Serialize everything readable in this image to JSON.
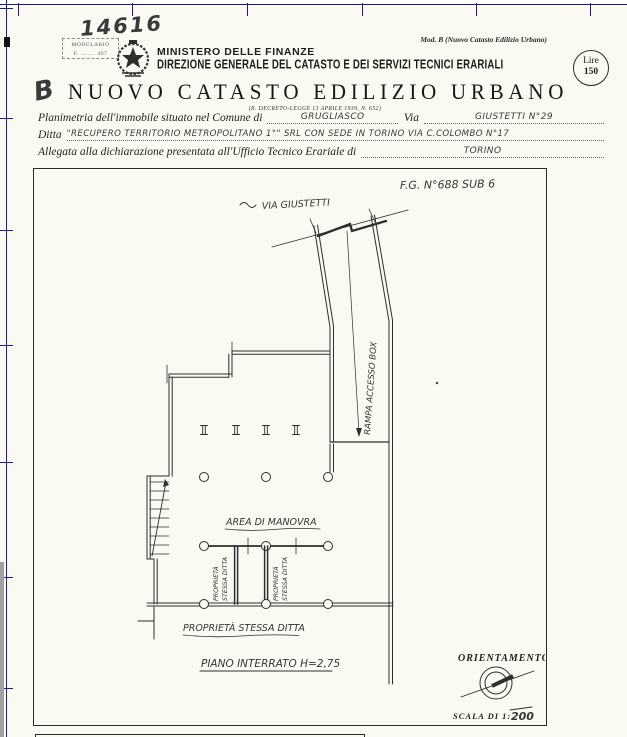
{
  "header": {
    "handwritten_number": "14616",
    "modulario_line1": "MODULARIO",
    "modulario_line2": "F. ........ 497",
    "mod_b_note": "Mod. B (Nuovo Catasto Edilizio Urbano)",
    "ministry": "MINISTERO DELLE FINANZE",
    "direction": "DIREZIONE GENERALE DEL CATASTO E DEI SERVIZI TECNICI ERARIALI",
    "stamp_mark": "B",
    "title": "NUOVO CATASTO EDILIZIO URBANO",
    "subtitle": "(R. DECRETO-LEGGE 13 APRILE 1939, N. 652)",
    "fee_line1": "Lire",
    "fee_line2": "150"
  },
  "form": {
    "line1_label": "Planimetria dell'immobile situato nel Comune di",
    "line1_value": "GRUGLIASCO",
    "line1_label2": "Via",
    "line1_value2": "GIUSTETTI  N°29",
    "line2_label": "Ditta",
    "line2_value": "\"RECUPERO TERRITORIO METROPOLITANO 1°\" SRL CON SEDE IN TORINO VIA C.COLOMBO N°17",
    "line3_label": "Allegata alla dichiarazione presentata all'Ufficio Tecnico Erariale di",
    "line3_value": "TORINO"
  },
  "plan": {
    "sheet_ref": "F.G.  N°688  SUB 6",
    "street_label": "VIA GIUSTETTI",
    "ramp_label": "RAMPA ACCESSO BOX",
    "area_label": "AREA DI MANOVRA",
    "property_word1": "PROPRIETÀ",
    "property_word2": "STESSA DITTA",
    "property_label_bottom": "PROPRIETÀ STESSA DITTA",
    "floor_label": "PIANO INTERRATO H=2,75",
    "orientation_label": "ORIENTAMENTO",
    "scale_label": "SCALA DI 1:",
    "scale_value": "200"
  },
  "colors": {
    "registration_rule": "#1a1a8c",
    "ink": "#2b2b2b",
    "paper": "#fbfaf2"
  }
}
